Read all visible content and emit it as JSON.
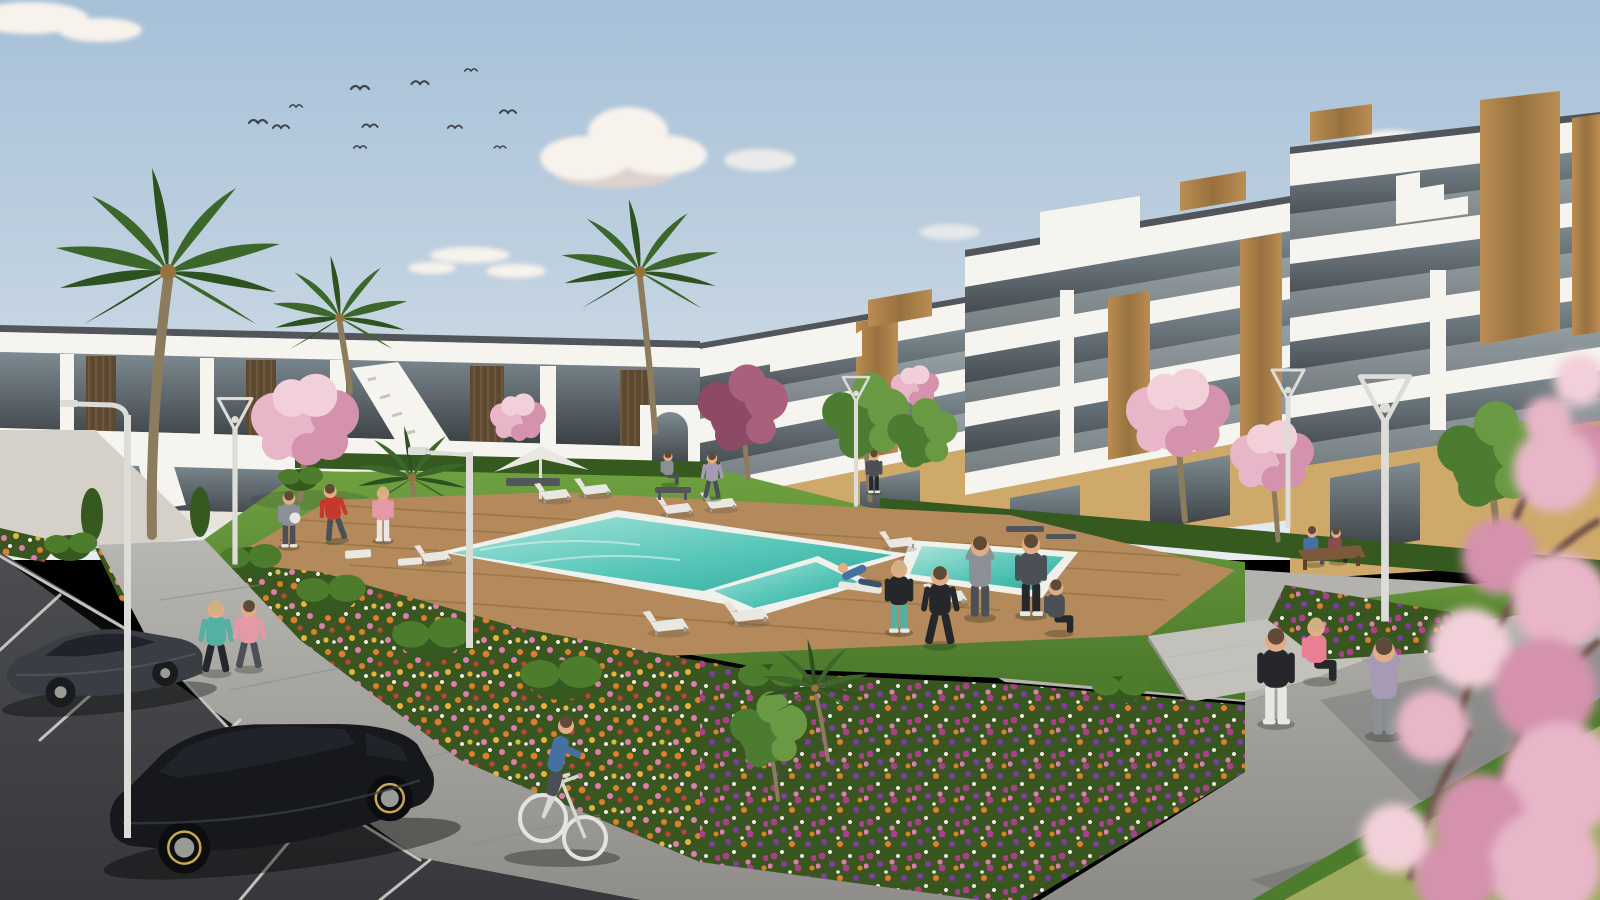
{
  "scene": {
    "type": "architectural-3d-render",
    "setting": "modern white apartment complex courtyard with swimming pool, lawn, flower beds, palm and cherry-blossom trees, parking lot",
    "time_of_day": "daytime, clear sky with scattered clouds",
    "counts": {
      "birds": 11,
      "clouds": 5,
      "cars": 2,
      "palm_trees": 7,
      "blossom_trees": 5,
      "green_trees": 4,
      "pool_sections": 3,
      "sun_loungers": 9,
      "street_lamps": 6,
      "people": 20,
      "benches": 3,
      "staircases": 2,
      "parasols": 1
    },
    "people_roles": [
      "jogger-teal",
      "jogger-pink",
      "exerciser-gray",
      "exerciser-red-kicking",
      "exerciser-pink",
      "walker-lavender",
      "bench-sitter",
      "stander-dark",
      "lounger-recliner-blue",
      "woman-sportsbra-teal-leggings",
      "man-stretching-arm-up",
      "man-dark-tee-shorts",
      "tracksuit-pointer",
      "yoga-seated",
      "plaza-woman-white-leggings",
      "plaza-seated-pink",
      "plaza-arms-up-hoodie",
      "bench-couple-blue",
      "bench-couple-maroon",
      "cyclist-blue-sweater"
    ],
    "vehicles": [
      "dark-grey-sedan",
      "black-hatchback"
    ],
    "pool": {
      "shape": "L-shaped with two auxiliary basins",
      "surround": "wooden deck"
    }
  },
  "palette": {
    "sky_top": "#a6c0d8",
    "sky_mid": "#c3d3e1",
    "sky_low": "#e8edf0",
    "cloud": "#f7f2ec",
    "cloud_shade": "#ded3cc",
    "bird": "#3f444b",
    "bld_white": "#f6f4ef",
    "bld_shade": "#e8e4dd",
    "bld_grey": "#d5d1c9",
    "roof_cap": "#52565a",
    "glass_hi": "#7e8b92",
    "glass_lo": "#383e42",
    "bal_glass": "#ccd6da",
    "wood": "#bb8d52",
    "wood_dk": "#97713f",
    "slat_dk": "#5d4932",
    "slat_lt": "#6f573c",
    "cream": "#cfa96a",
    "trunk": "#8c7b5d",
    "palm": "#3c672a",
    "palm_dk": "#2d5220",
    "blossom_1": "#e8b6c8",
    "blossom_2": "#f2d0da",
    "blossom_3": "#d492ad",
    "purple_1": "#8c4a64",
    "purple_2": "#a8607c",
    "tree_1": "#4c7c31",
    "tree_2": "#699a43",
    "hedge": "#36591f",
    "hedge_lt": "#4c7c2c",
    "lawn_1": "#6fa03f",
    "lawn_2": "#49762a",
    "lawn_corner": "#9cab5e",
    "bed_base": "#3a5620",
    "fl_orange": "#dd7f2b",
    "fl_yellow": "#e2b73e",
    "fl_pink": "#dc7fae",
    "fl_magenta": "#ab3f8d",
    "fl_purple": "#7d3da2",
    "fl_red": "#bf4437",
    "fl_white": "#efe9e2",
    "deck": "#b4895b",
    "deck_ln": "#93703f",
    "pool_1": "#a9e4d9",
    "pool_2": "#56c6b8",
    "pool_3": "#2fa89c",
    "coping": "#f0f1eb",
    "terrace": "#b3b2ad",
    "plaza_1": "#a9a8a3",
    "plaza_2": "#8c8b87",
    "step": "#c2c1bc",
    "walk_1": "#b7b6b1",
    "walk_2": "#8f8e8a",
    "asphalt_1": "#4b4d50",
    "asphalt_2": "#36383b",
    "line": "#d8d8d3",
    "car_grey": "#3a3d43",
    "car_black": "#17181b",
    "car_glass": "#20242a",
    "rim": "#9a9a96",
    "rim_gold": "#c9a84e",
    "lamp": "#dcdcd8",
    "lamp_dk": "#9a9a96",
    "skin": "#e2ad85",
    "hair_dk": "#5f4a38",
    "hair_lt": "#cdb184",
    "c_teal": "#54b0a0",
    "c_pink": "#e598a6",
    "c_red": "#c6382b",
    "c_blue": "#46709f",
    "c_gray": "#8b9096",
    "c_dgray": "#4b5056",
    "c_black": "#25272b",
    "c_lav": "#a79ab5",
    "c_white": "#e9e7e2",
    "c_maroon": "#8a4a52",
    "c_denim": "#3c536e",
    "c_rose": "#e87f92"
  }
}
